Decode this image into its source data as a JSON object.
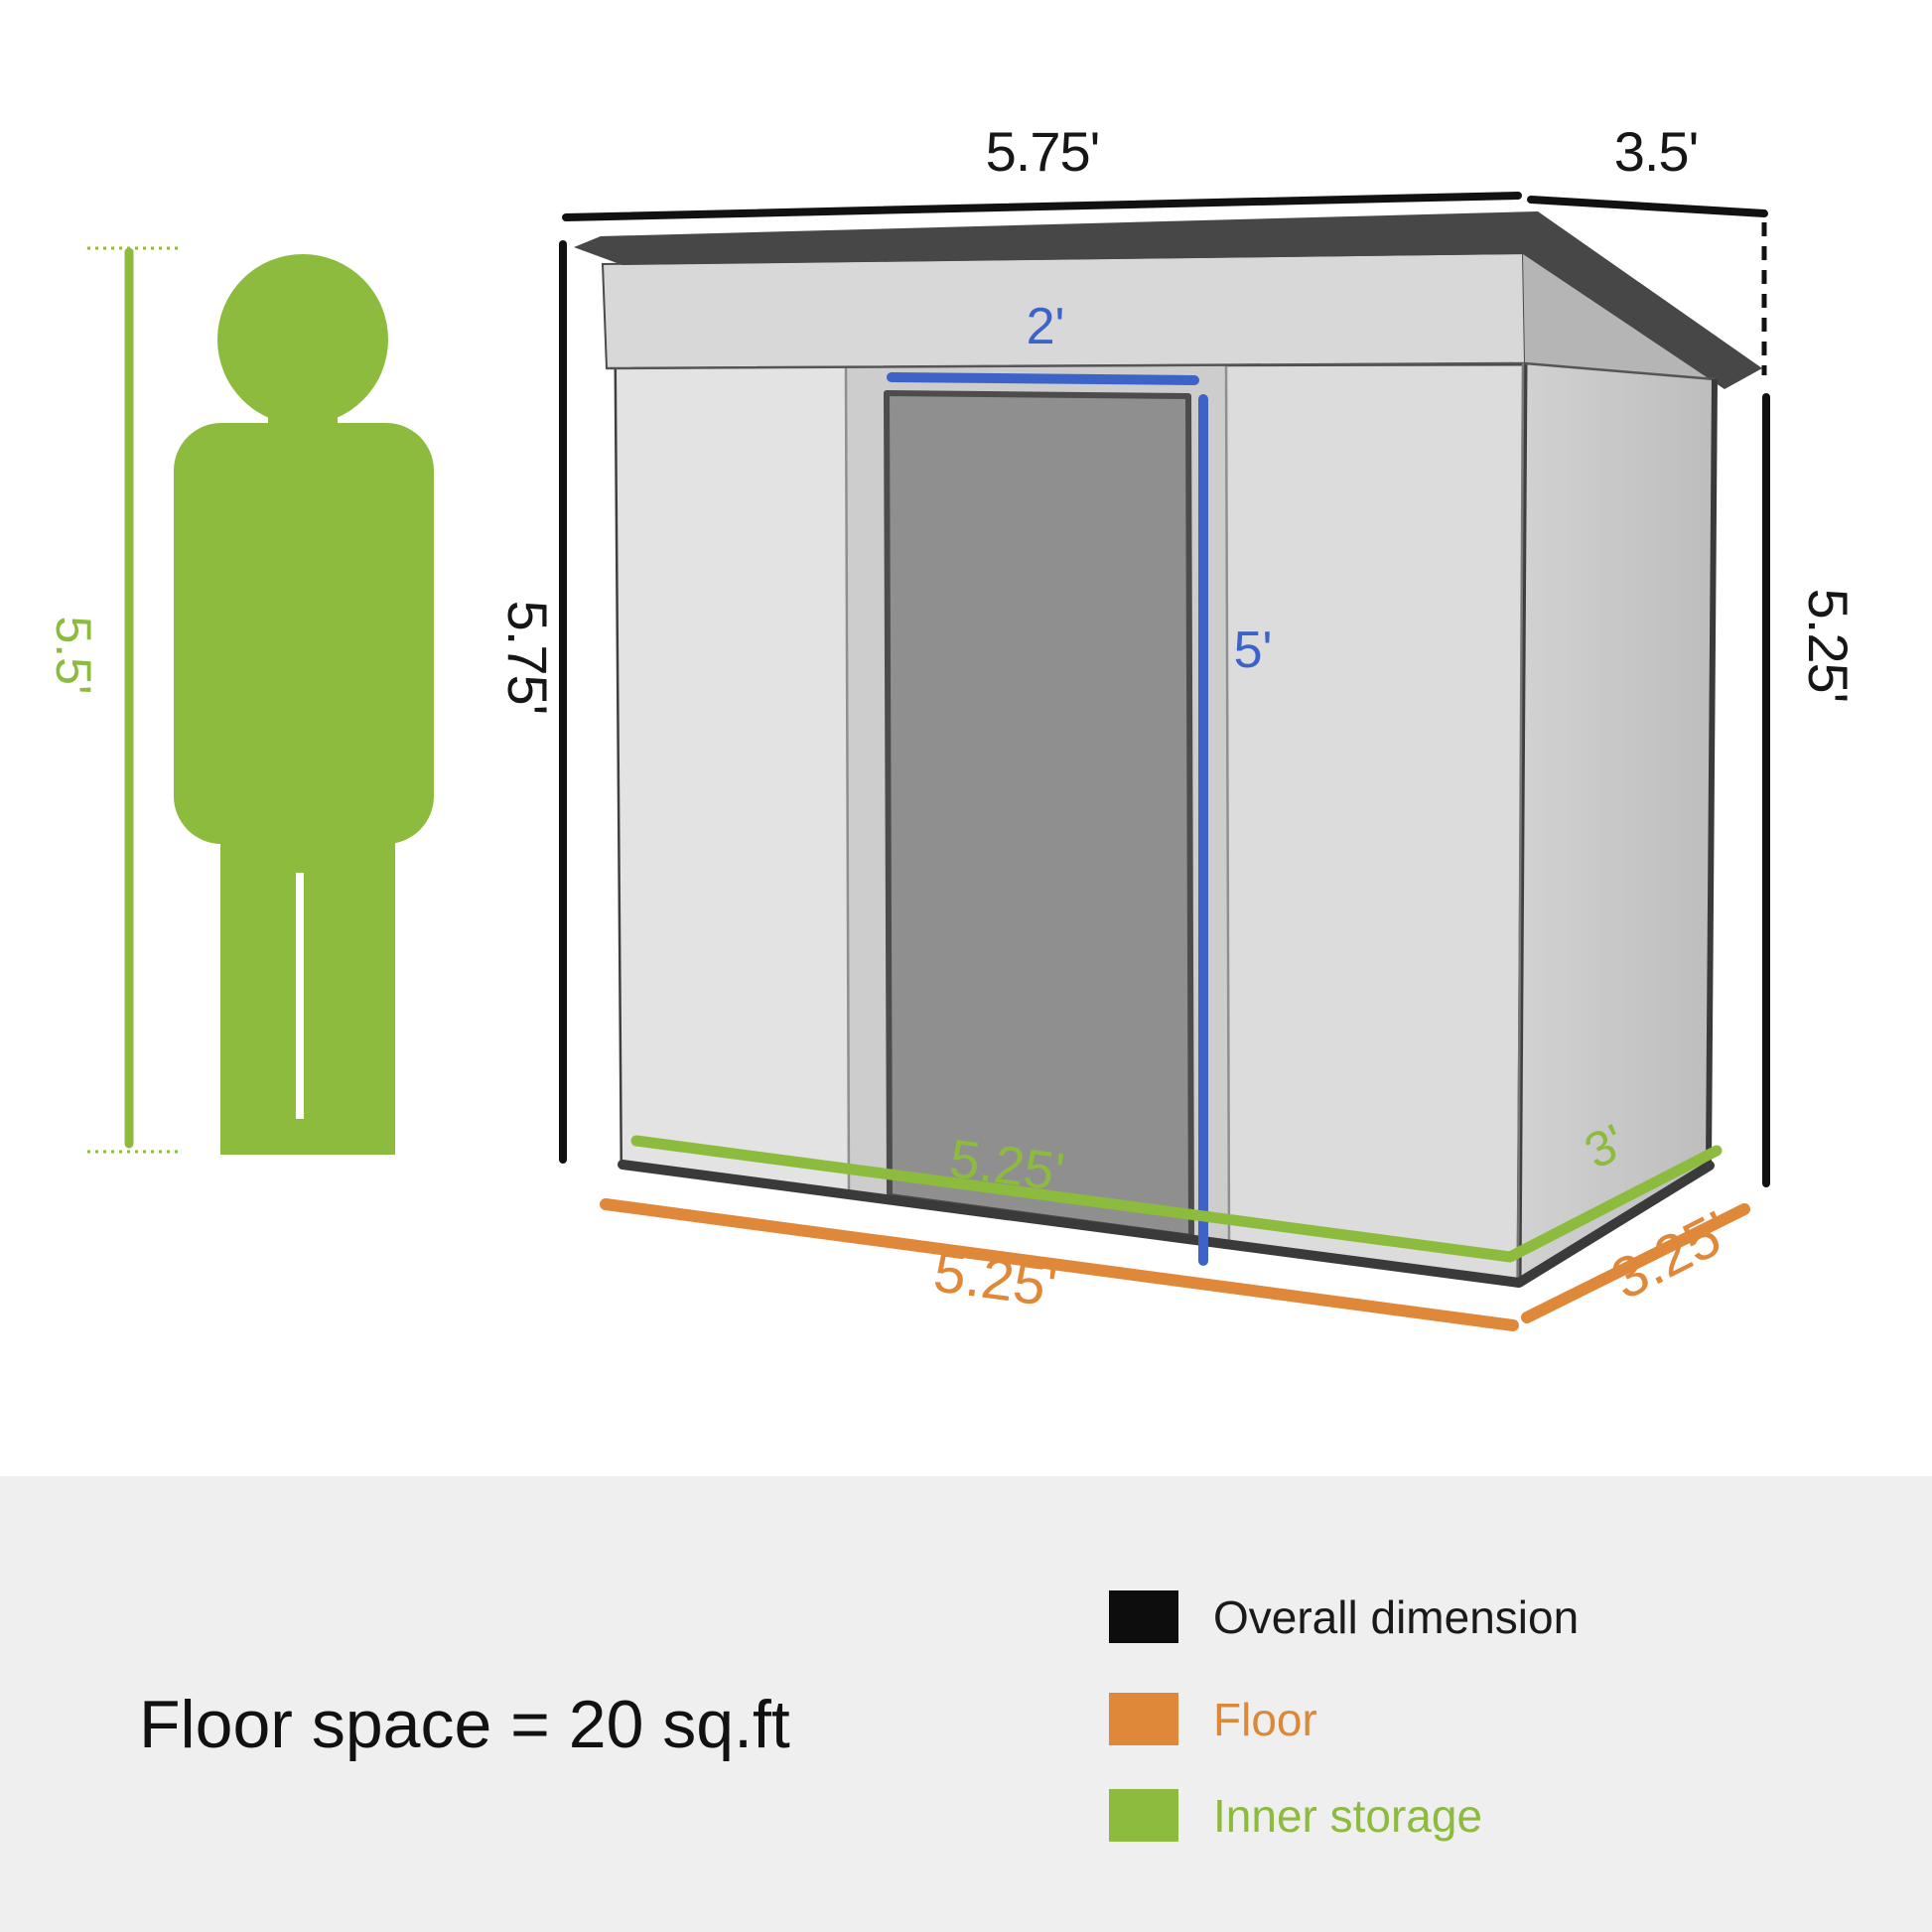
{
  "diagram": {
    "person": {
      "height_label": "5.5'"
    },
    "shed": {
      "overall_width_label": "5.75'",
      "overall_depth_label": "3.5'",
      "overall_height_left_label": "5.75'",
      "overall_height_right_label": "5.25'",
      "door_width_label": "2'",
      "door_height_label": "5'",
      "inner_width_label": "5.25'",
      "inner_depth_label": "3'",
      "floor_width_label": "5.25'",
      "floor_depth_label": "3.25'"
    },
    "colors": {
      "overall_dimension": "#111111",
      "floor": "#e0883a",
      "inner_storage": "#8cbb3e",
      "door_dimension_blue": "#3c63c8",
      "roof_dark": "#474747",
      "wall_light": "#dcdcdc"
    }
  },
  "footer": {
    "floor_space_text": "Floor space = 20 sq.ft",
    "legend": [
      {
        "label": "Overall dimension",
        "label_color": "#1a1a1a",
        "swatch_color": "#0d0d0d"
      },
      {
        "label": "Floor",
        "label_color": "#dc8839",
        "swatch_color": "#e0883a"
      },
      {
        "label": "Inner storage",
        "label_color": "#8cbb3e",
        "swatch_color": "#8cbb3e"
      }
    ]
  }
}
